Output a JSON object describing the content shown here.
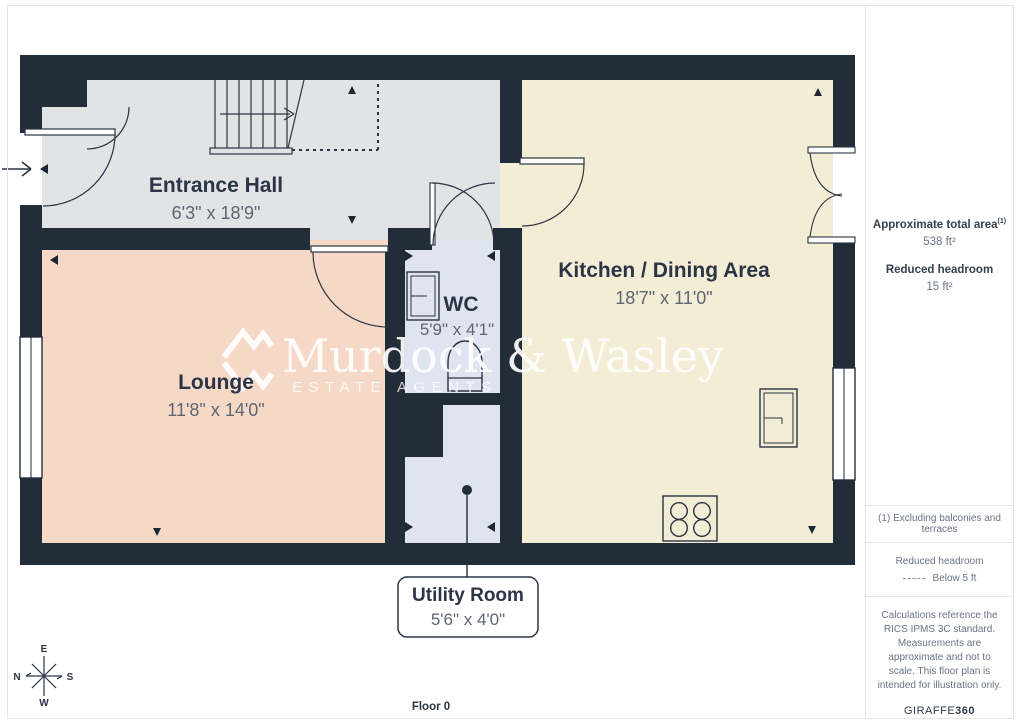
{
  "floorplan": {
    "floor_label": "Floor 0",
    "rooms": [
      {
        "id": "entrance-hall",
        "name": "Entrance Hall",
        "dimensions": "6'3\" x 18'9\""
      },
      {
        "id": "lounge",
        "name": "Lounge",
        "dimensions": "11'8\" x 14'0\""
      },
      {
        "id": "wc",
        "name": "WC",
        "dimensions": "5'9\" x 4'1\""
      },
      {
        "id": "kitchen",
        "name": "Kitchen / Dining Area",
        "dimensions": "18'7\" x 11'0\""
      },
      {
        "id": "utility",
        "name": "Utility Room",
        "dimensions": "5'6\" x 4'0\""
      }
    ],
    "watermark": {
      "name": "Murdock & Wasley",
      "subtitle": "ESTATE AGENTS"
    },
    "compass": {
      "top": "E",
      "left": "N",
      "right": "S",
      "bottom": "W"
    },
    "colors": {
      "wall": "#222d3a",
      "hall_floor": "#e2e3e5",
      "lounge_floor": "#f6d8c7",
      "kitchen_floor": "#f4edd5",
      "wet_room_floor": "#dfe4f0",
      "room_name_text": "#2b3547",
      "dims_text": "#5d6672"
    }
  },
  "sidebar": {
    "total_area_label": "Approximate total area",
    "total_area_sup": "(1)",
    "total_area_value": "538 ft²",
    "reduced_headroom_label": "Reduced headroom",
    "reduced_headroom_value": "15 ft²",
    "note_1": "(1) Excluding balconies and terraces",
    "legend_title": "Reduced headroom",
    "legend_value": "Below 5 ft",
    "disclaimer": "Calculations reference the RICS IPMS 3C standard. Measurements are approximate and not to scale. This floor plan is intended for illustration only.",
    "brand_normal": "GIRAFFE",
    "brand_bold": "360"
  }
}
